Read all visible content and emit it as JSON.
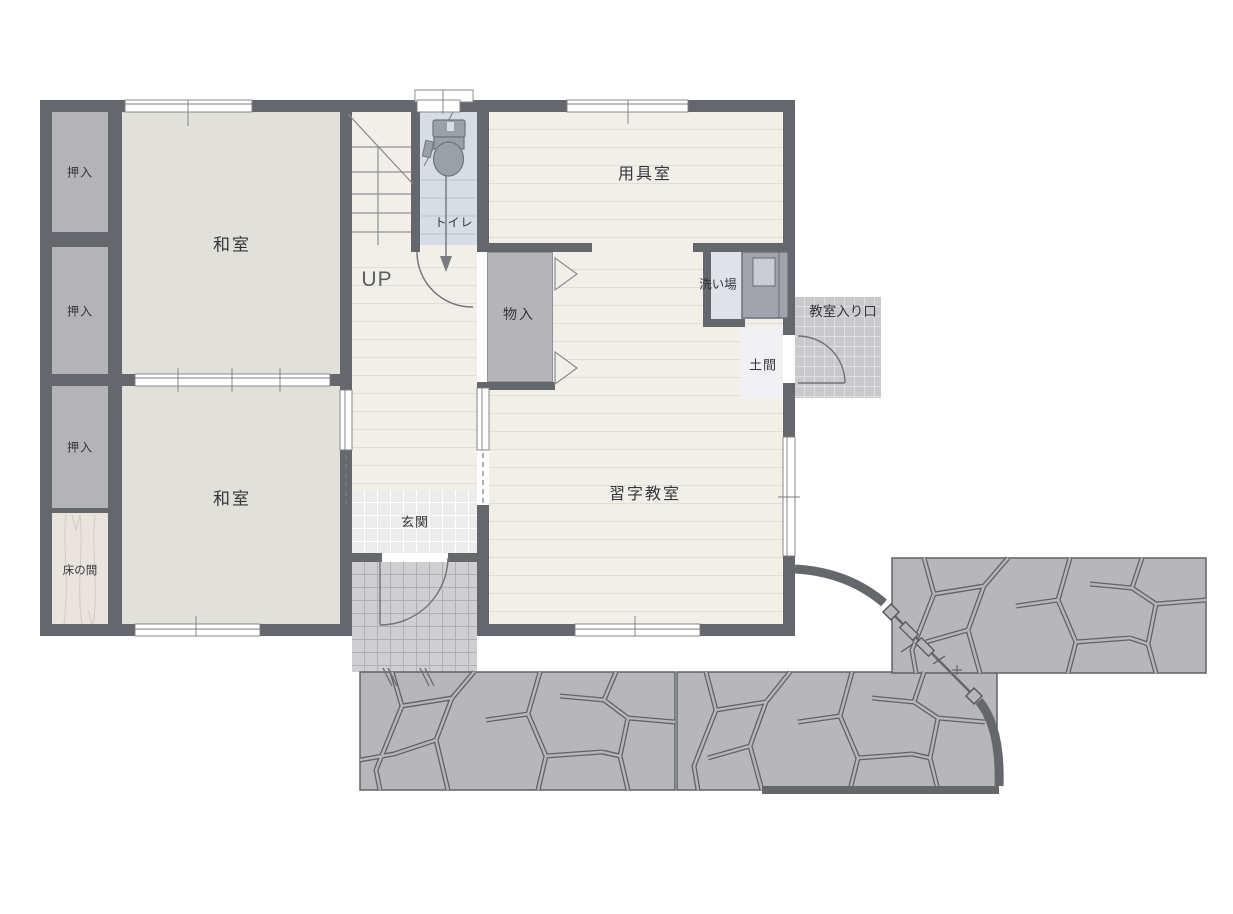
{
  "plan": {
    "title": "floor-plan",
    "colors": {
      "wall": "#64676c",
      "tatami_floor": "#e1e1d9",
      "wood_floor": "#f1efe8",
      "storage_gray": "#b4b4b6",
      "wet_area_blue": "#dfe3e7",
      "stone_path": "#b7b7b9",
      "entry_tile": "#c9c9cc"
    },
    "rooms": {
      "oshiire_1": {
        "label": "押入"
      },
      "oshiire_2": {
        "label": "押入"
      },
      "oshiire_3": {
        "label": "押入"
      },
      "tokonoma": {
        "label": "床の間"
      },
      "washitsu_upper": {
        "label": "和室"
      },
      "washitsu_lower": {
        "label": "和室"
      },
      "toilet": {
        "label": "トイレ"
      },
      "stairs": {
        "label": "UP"
      },
      "yogushitsu": {
        "label": "用具室"
      },
      "monoire": {
        "label": "物入"
      },
      "araiba": {
        "label": "洗い場"
      },
      "doma": {
        "label": "土間"
      },
      "kyoshitsu_iriguchi": {
        "label": "教室入り口"
      },
      "genkan": {
        "label": "玄関"
      },
      "shuji_kyoshitsu": {
        "label": "習字教室"
      }
    }
  }
}
